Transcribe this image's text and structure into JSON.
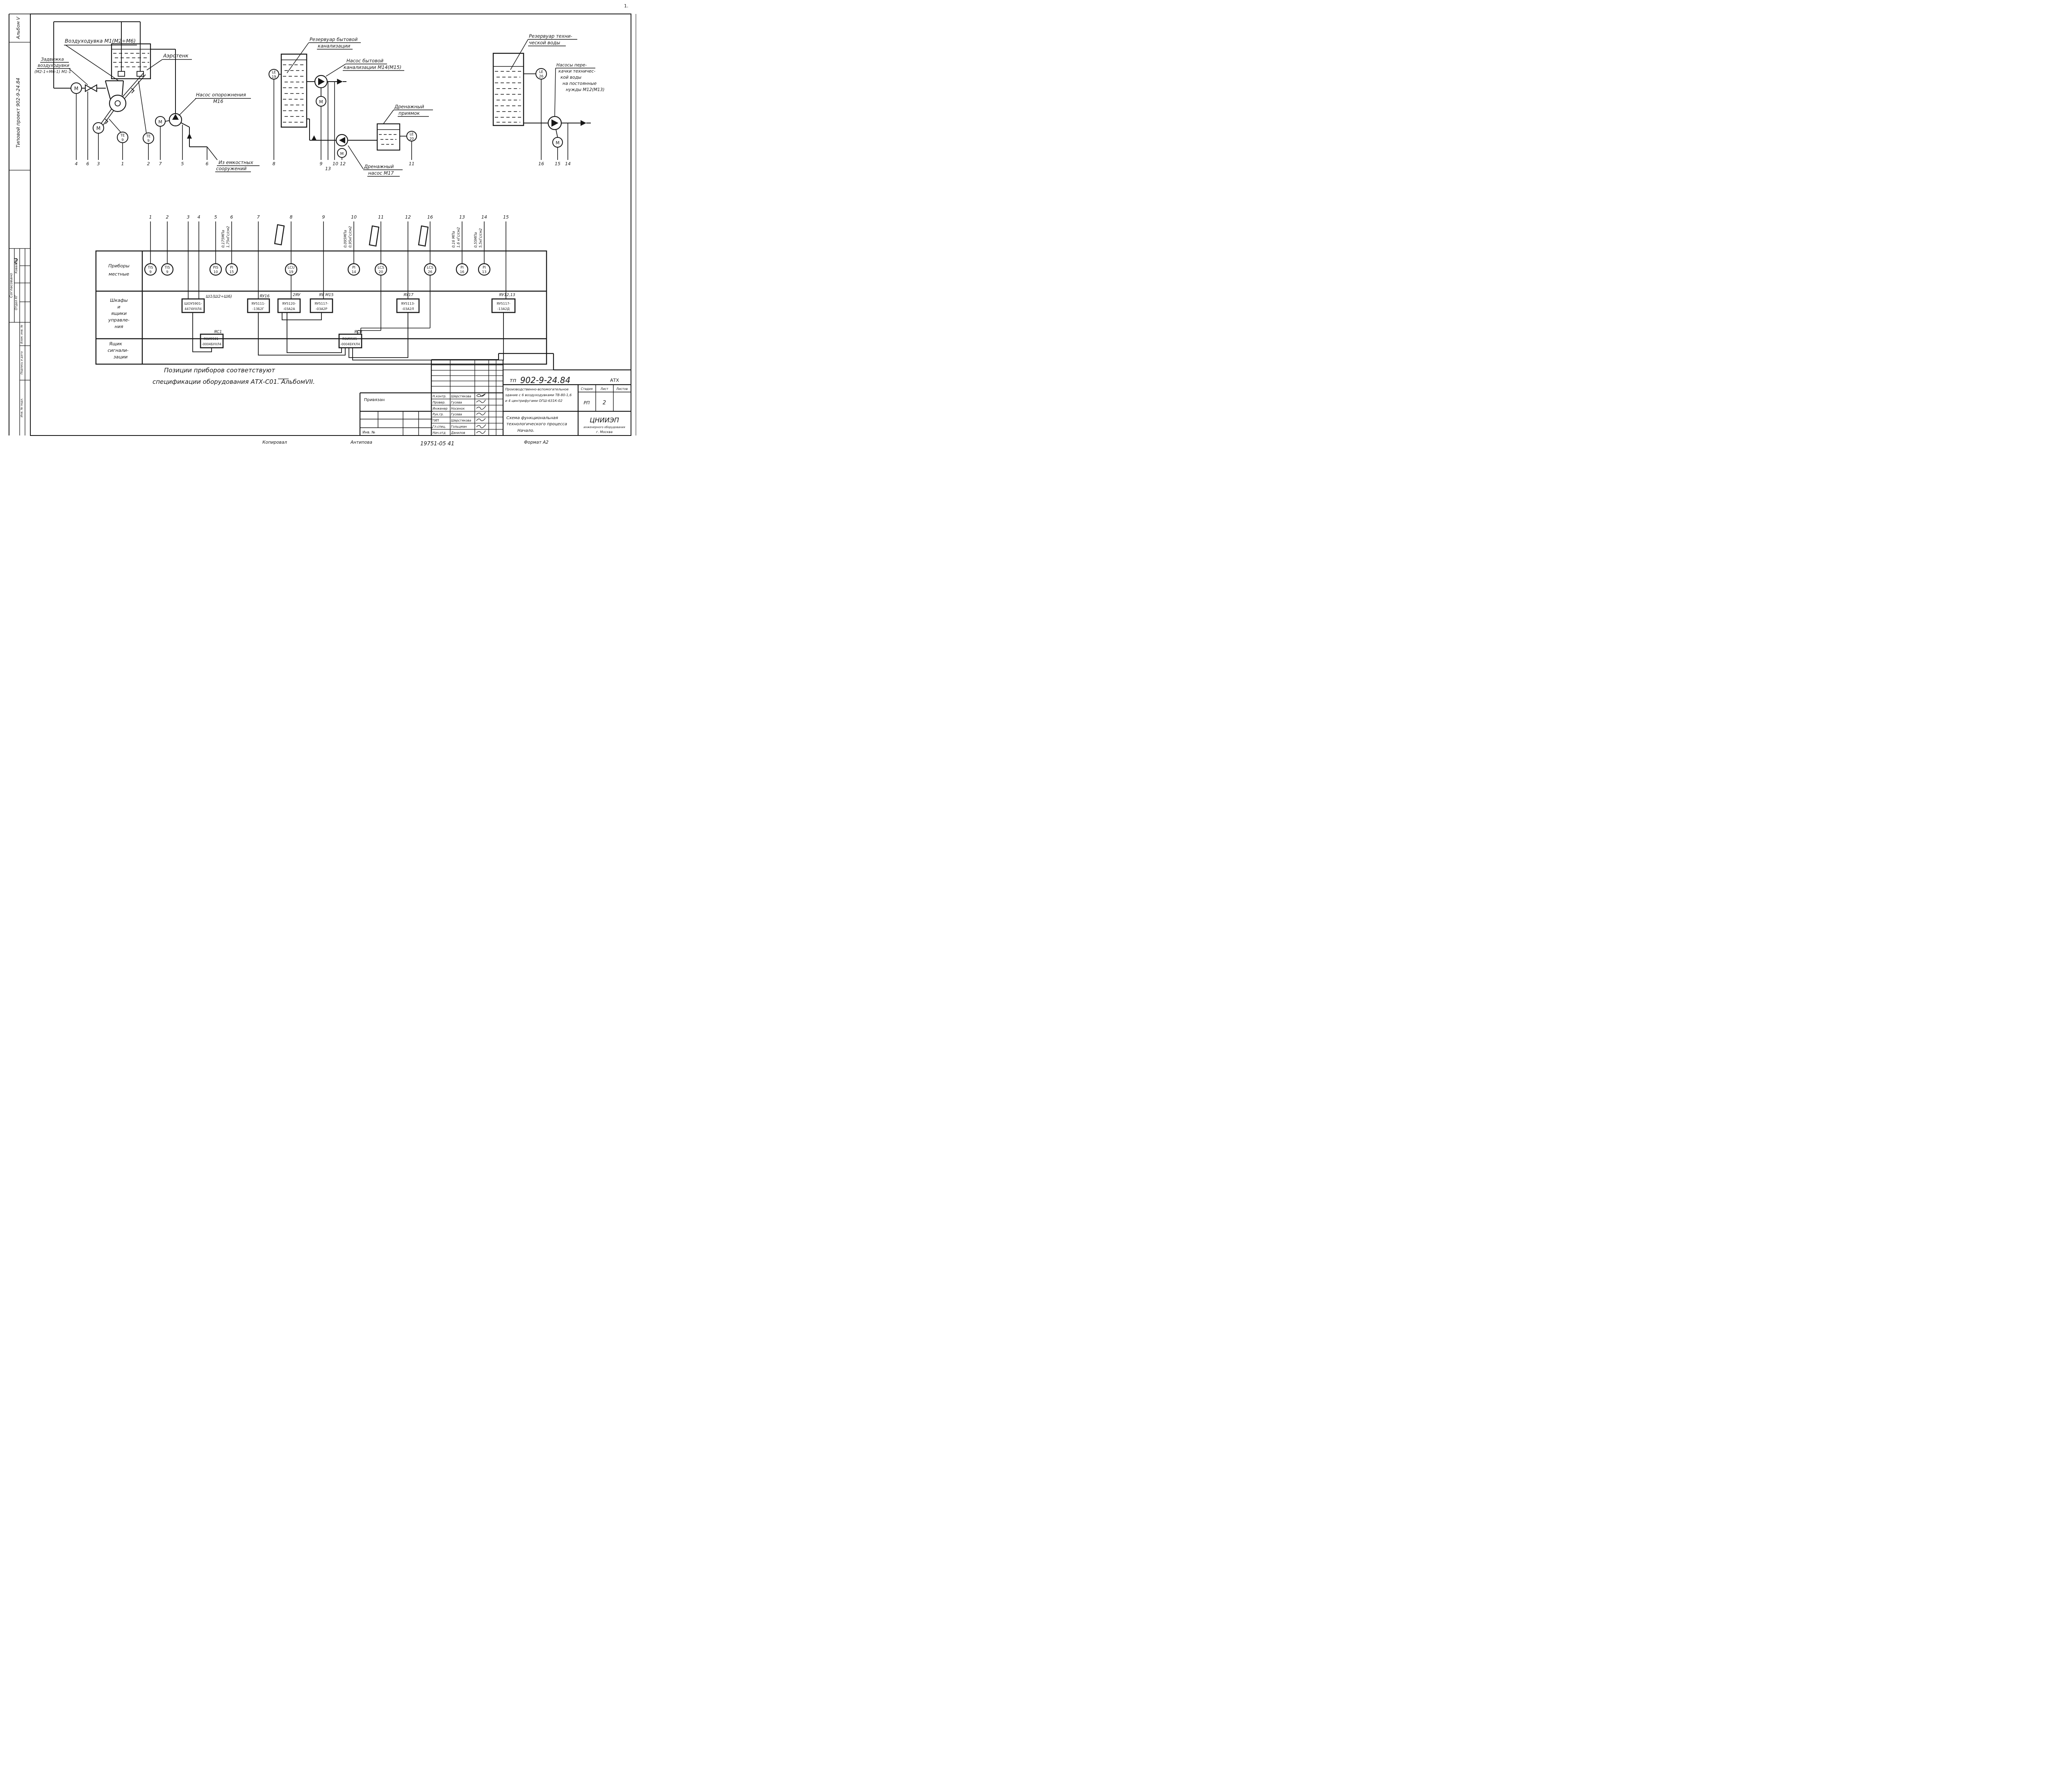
{
  "margin": {
    "album": "Альбом V",
    "project": "Типовой проект 902-9-24.84",
    "soglasovano": "Согласовано",
    "otdel": "Отдел КГ",
    "kovaleva": "Ковалева",
    "vzam": "Взам. инв. №",
    "podpis": "Подпись и дата",
    "inv_podl": "Инв. № подл.",
    "corner_mark": "1."
  },
  "sym": {
    "m": "М",
    "te": "ТЕ",
    "te_n": "9",
    "le": "LE",
    "le19": "19",
    "le20": "20",
    "le26": "26"
  },
  "d1": {
    "blower": "Воздуходувка М1(М2÷М6)",
    "valve1": "Задвижка",
    "valve2": "воздуходувки",
    "valve3": "(М2-1÷М6-1) М1-1",
    "aerotank": "Аэротенк",
    "pump1": "Насос опорожнения",
    "pump2": "М16",
    "src1": "Из емкостных",
    "src2": "сооружений",
    "n": [
      "4",
      "6",
      "3",
      "1",
      "2",
      "7",
      "5",
      "6"
    ]
  },
  "d2": {
    "tank1": "Резервуар бытовой",
    "tank2": "канализации",
    "pump1": "Насос бытовой",
    "pump2": "канализации М14(М15)",
    "pit1": "Дренажный",
    "pit2": "приямок",
    "dpump1": "Дренажный",
    "dpump2": "насос М17",
    "n": [
      "8",
      "9",
      "13",
      "10",
      "12",
      "11"
    ]
  },
  "d3": {
    "tank1": "Резервуар техни-",
    "tank2": "ческой воды",
    "pump1": "Насосы пере-",
    "pump2": "качки техничес-",
    "pump3": "кой воды",
    "pump4": "на постоянные",
    "pump5": "нужды М12(М13)",
    "n": [
      "16",
      "15",
      "14"
    ]
  },
  "tbl": {
    "r1": [
      "Приборы",
      "местные"
    ],
    "r2": [
      "Шкафы",
      "и",
      "ящики",
      "управле-",
      "ния"
    ],
    "r3": [
      "Ящик",
      "сигнали-",
      "зации"
    ],
    "nums": [
      "1",
      "2",
      "3",
      "4",
      "5",
      "6",
      "7",
      "8",
      "9",
      "10",
      "11",
      "12",
      "16",
      "13",
      "14",
      "15"
    ],
    "inst": [
      {
        "t": "TIS",
        "n": "9"
      },
      {
        "t": "TIS",
        "n": "9"
      },
      {
        "t": "PIS",
        "n": "10"
      },
      {
        "t": "PI",
        "n": "15"
      },
      {
        "t": "LCU",
        "n": "19"
      },
      {
        "t": "PI",
        "n": "14"
      },
      {
        "t": "LCS",
        "n": "20"
      },
      {
        "t": "LCS",
        "n": "26"
      },
      {
        "t": "PI",
        "n": "16"
      },
      {
        "t": "PI",
        "n": "13"
      }
    ],
    "p": [
      {
        "a": "0,175МПа",
        "b": "1,75кГс/см2"
      },
      {
        "a": "0,095МПа",
        "b": "0,95кГс/см2"
      },
      {
        "a": "0,16 МПа",
        "b": "1,6 кГс/см2"
      },
      {
        "a": "0,55МПа",
        "b": "5,5кГс/см2"
      }
    ],
    "box": [
      {
        "tag": "Ш1(Ш2÷Ш6)",
        "l1": "ШОУ5901-",
        "l2": "4474УХЛ4"
      },
      {
        "tag": "ЯУ16",
        "l1": "ЯУ5111-",
        "l2": "-13Б2Г"
      },
      {
        "tag": "2ЯУ",
        "l1": "ЯУ5120-",
        "l2": "-03А2А"
      },
      {
        "tag": "ЯУ М15",
        "l1": "ЯУ5117-",
        "l2": "-03А2Р"
      },
      {
        "tag": "ЯУ17",
        "l1": "ЯУ5113-",
        "l2": "-03А2Л"
      },
      {
        "tag": "ЯУ12,13",
        "l1": "ЯУ5117-",
        "l2": "-13А2Д"
      }
    ],
    "sig": [
      {
        "tag": "ЯС1",
        "l1": "ЯОИ9501-",
        "l2": "-0004БУХЛ4"
      },
      {
        "tag": "ЯСВ",
        "l1": "ЯОИ9501-",
        "l2": "-0004БУХЛ4"
      }
    ]
  },
  "note": {
    "l1": "Позиции приборов соответствуют",
    "l2": "спецификации оборудования АТХ-С01. АльбомVII."
  },
  "tb": {
    "doc_prefix": "тп",
    "doc": "902-9-24.84",
    "code": "АТХ",
    "rows": [
      {
        "r": "Н.контр.",
        "n": "Шерстякова"
      },
      {
        "r": "Провер.",
        "n": "Гусева"
      },
      {
        "r": "Инженер",
        "n": "Носенок"
      },
      {
        "r": "Рук.гр.",
        "n": "Гусева"
      },
      {
        "r": "ГИП",
        "n": "Шерстякова"
      },
      {
        "r": "Гл.спец.",
        "n": "Гольцман"
      },
      {
        "r": "Нач.отд",
        "n": "Данилов"
      }
    ],
    "b1": "Производственно-вспомогательное",
    "b2": "здание с 6 воздуходувками ТВ-80-1,6",
    "b3": "и 4 центрифугами ОГШ-631К-02",
    "s1": "Схема функциональная",
    "s2": "технологического процесса",
    "s3": "Начало.",
    "stage_h": "Стадия",
    "sheet_h": "Лист",
    "sheets_h": "Листов",
    "stage": "РП",
    "sheet": "2",
    "org1": "ЦНИИЭП",
    "org2": "инженерного оборудования",
    "org3": "г. Москва",
    "privyazan": "Привязан",
    "inv": "Инв. №",
    "kopiroval": "Копировал",
    "kopiroval_name": "Антипова",
    "order_no": "19751-05 41",
    "format": "Формат А2"
  }
}
